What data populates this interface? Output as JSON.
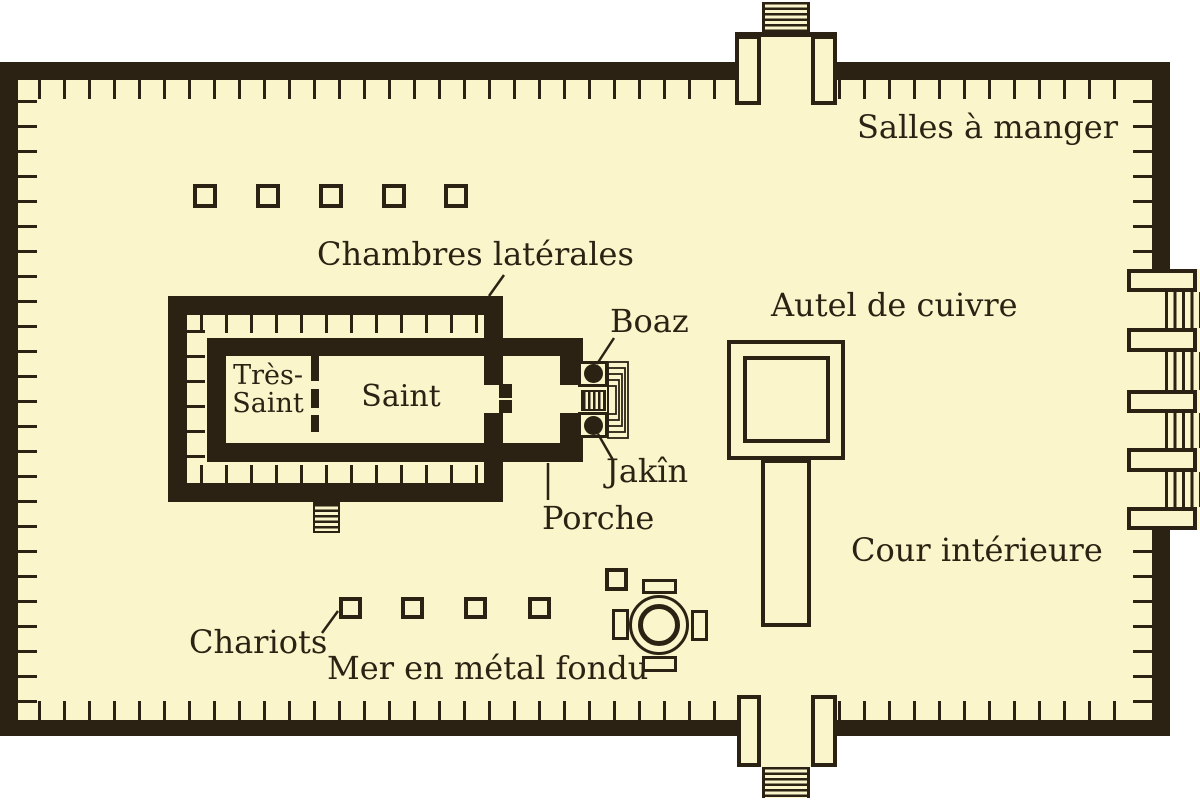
{
  "title": "Plan du temple de Salomon",
  "colors": {
    "parchment": "#faf5cb",
    "ink": "#2b2213",
    "white": "#ffffff"
  },
  "labels": {
    "salles_a_manger": "Salles à manger",
    "chambres_laterales": "Chambres latérales",
    "boaz": "Boaz",
    "jakin": "Jakîn",
    "porche": "Porche",
    "tres_saint_line1": "Très-",
    "tres_saint_line2": "Saint",
    "saint": "Saint",
    "autel_de_cuivre": "Autel de cuivre",
    "cour_interieure": "Cour intérieure",
    "chariots": "Chariots",
    "mer_en_metal_fondu": "Mer en métal fondu"
  },
  "features": {
    "north_storage_squares": 5,
    "chariot_squares": 4,
    "sea_side_square": 1,
    "east_gate_bars": 5,
    "east_gate_hatched_passages": 4,
    "pillars": [
      "Boaz",
      "Jakîn"
    ],
    "gates": [
      "north-gate",
      "south-gate",
      "east-gate"
    ]
  }
}
